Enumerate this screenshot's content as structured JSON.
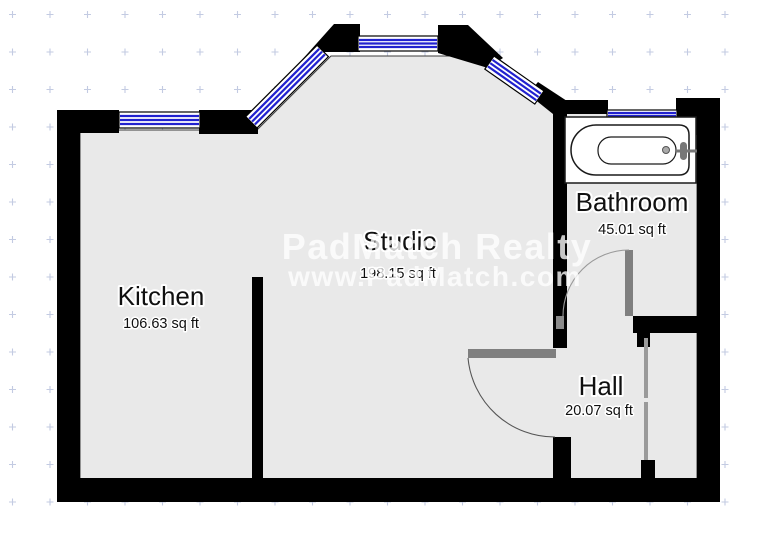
{
  "rooms": [
    {
      "name": "Kitchen",
      "area": "106.63 sq ft"
    },
    {
      "name": "Studio",
      "area": "198.15 sq ft"
    },
    {
      "name": "Bathroom",
      "area": "45.01 sq ft"
    },
    {
      "name": "Hall",
      "area": "20.07 sq ft"
    }
  ],
  "watermark": {
    "line1": "PadMatch Realty",
    "line2": "www.PadMatch.com"
  },
  "icons": {
    "bathtub": "bathtub-icon"
  },
  "colors": {
    "wall": "#000000",
    "floor": "#e9e9e9",
    "window_blue": "#2121cf",
    "door_gray": "#7f7f7f",
    "closet_door_gray": "#9a9a9a",
    "grid_dot": "#c3cbe2",
    "watermark_white": "#ffffff"
  }
}
